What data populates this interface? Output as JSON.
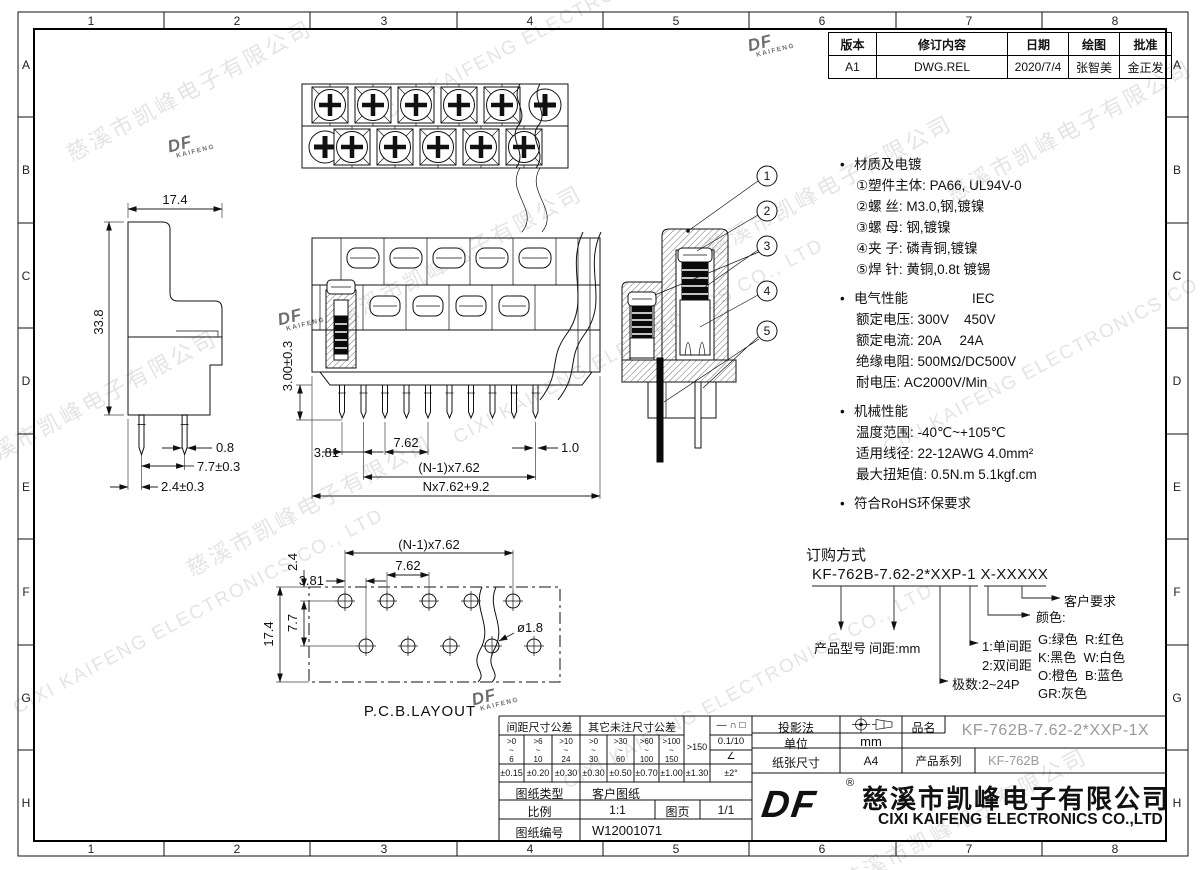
{
  "border": {
    "cols": [
      "1",
      "2",
      "3",
      "4",
      "5",
      "6",
      "7",
      "8"
    ],
    "rows": [
      "A",
      "B",
      "C",
      "D",
      "E",
      "F",
      "G",
      "H"
    ]
  },
  "revision": {
    "headers": [
      "版本",
      "修订内容",
      "日期",
      "绘图",
      "批准"
    ],
    "cells": [
      "A1",
      "DWG.REL",
      "2020/7/4",
      "张智美",
      "金正发"
    ]
  },
  "notes": {
    "bullet": "•",
    "material_title": "材质及电镀",
    "material_items": [
      "①塑件主体: PA66, UL94V-0",
      "②螺 丝: M3.0,钢,镀镍",
      "③螺 母: 钢,镀镍",
      "④夹 子: 磷青铜,镀镍",
      "⑤焊 针: 黄铜,0.8t 镀锡"
    ],
    "electrical_title": "电气性能",
    "electrical_std": "IEC",
    "electrical_items": [
      "额定电压: 300V    450V",
      "额定电流: 20A     24A",
      "绝缘电阻: 500MΩ/DC500V",
      "耐电压: AC2000V/Min"
    ],
    "mechanical_title": "机械性能",
    "mechanical_items": [
      "温度范围: -40℃~+105℃",
      "适用线径: 22-12AWG 4.0mm²",
      "最大扭矩值: 0.5N.m 5.1kgf.cm"
    ],
    "rohs": "符合RoHS环保要求"
  },
  "ordering": {
    "title": "订购方式",
    "code": "KF-762B-7.62-2*XXP-1 X-XXXXX",
    "model_label": "产品型号",
    "pitch_label": "间距:mm",
    "poles_label": "极数:2~24P",
    "row1": "1:单间距",
    "row2": "2:双间距",
    "color_label": "颜色:",
    "color_line1": "G:绿色  R:红色",
    "color_line2": "K:黑色  W:白色",
    "color_line3": "O:橙色  B:蓝色",
    "color_line4": "GR:灰色",
    "custom_label": "客户要求"
  },
  "views": {
    "pcb_caption": "P.C.B.LAYOUT",
    "callouts": [
      "1",
      "2",
      "3",
      "4",
      "5"
    ]
  },
  "dims": {
    "side_width": "17.4",
    "side_height": "33.8",
    "pin_width": "0.8",
    "pin_span": "7.7±0.3",
    "pin_offset": "2.4±0.3",
    "half_pitch": "3.81",
    "pitch": "7.62",
    "pin_tip": "1.0",
    "span": "(N-1)x7.62",
    "total": "Nx7.62+9.2",
    "pin_length": "3.00±0.3",
    "pcb_span": "(N-1)x7.62",
    "pcb_pitch": "7.62",
    "pcb_half_pitch": "3.81",
    "pcb_row_offset": "2.4",
    "pcb_row_gap": "7.7",
    "pcb_height": "17.4",
    "pcb_hole": "ø1.8"
  },
  "titleblock": {
    "tol": {
      "pitch_header": "间距尺寸公差",
      "other_header": "其它未注尺寸公差",
      "ranges": [
        ">0\n~\n6",
        ">6\n~\n10",
        ">10\n~\n24",
        ">0\n~\n30",
        ">30\n~\n60",
        ">60\n~\n100",
        ">100\n~\n150"
      ],
      "over": ">150",
      "values": [
        "±0.15",
        "±0.20",
        "±0.30",
        "±0.30",
        "±0.50",
        "±0.70",
        "±1.00",
        "±1.30"
      ],
      "angle_value": "±2°",
      "symbols": "— ∩ □",
      "flat": "0.1/10",
      "angle_symbol": "∠"
    },
    "type_label": "图纸类型",
    "type_value": "客户图纸",
    "scale_label": "比例",
    "scale_value": "1:1",
    "page_label": "图页",
    "page_value": "1/1",
    "no_label": "图纸编号",
    "no_value": "W12001071",
    "projection_label": "投影法",
    "unit_label": "单位",
    "unit_value": "mm",
    "paper_label": "纸张尺寸",
    "paper_value": "A4",
    "pn_label": "品名",
    "pn_value": "KF-762B-7.62-2*XXP-1X",
    "series_label": "产品系列",
    "series_value": "KF-762B",
    "company_cn": "慈溪市凯峰电子有限公司",
    "company_en": "CIXI KAIFENG ELECTRONICS CO.,LTD",
    "logo": "DF",
    "logo_sub": "KAIFENG",
    "reg": "®"
  },
  "watermark": {
    "cn": "慈溪市凯峰电子有限公司",
    "en": "CIXI KAIFENG ELECTRONICS CO., LTD",
    "logo": "DF",
    "logo_sub": "KAIFENG"
  }
}
